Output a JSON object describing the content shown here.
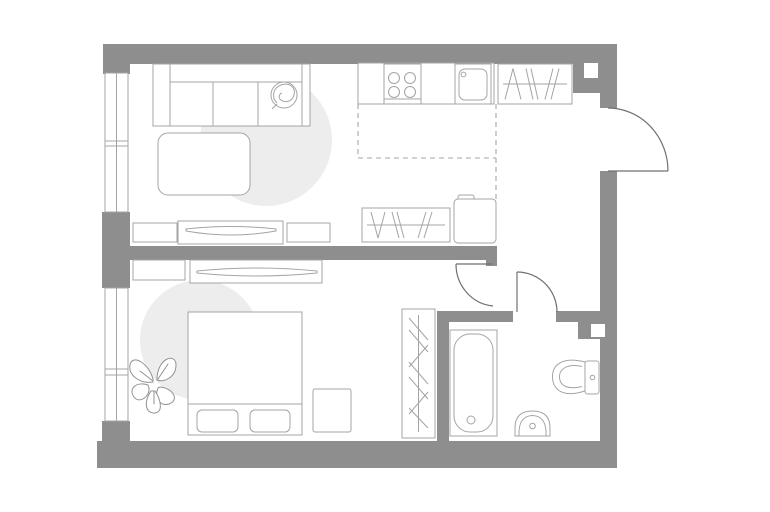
{
  "canvas": {
    "width": 770,
    "height": 512
  },
  "colors": {
    "background": "#ffffff",
    "wall": "#8e8e8e",
    "line": "#a4a4a4",
    "door_line": "#707070",
    "dash_line": "#a6a6a6",
    "rug": "#ededed",
    "plant_line": "#929292"
  },
  "drawing": {
    "type": "apartment-floor-plan",
    "fixtures": [
      "sofa-icon",
      "round-pillow-icon",
      "coffee-table-icon",
      "round-rug-icon",
      "tv-console-icon",
      "tv-icon",
      "media-cabinet-icon",
      "kitchen-counter-icon",
      "stove-icon",
      "kitchen-sink-icon",
      "wardrobe-hanging-clothes-icon",
      "refrigerator-icon",
      "kitchen-zone-dashed-boundary",
      "bed-icon",
      "bed-pillows-icon",
      "nightstand-icon",
      "dresser-icon",
      "plant-icon",
      "tall-wardrobe-icon",
      "bathtub-icon",
      "washbasin-icon",
      "toilet-icon",
      "window-icon",
      "entrance-door-swing-icon",
      "interior-door-swing-icon",
      "duct-shaft-icon"
    ],
    "doors": [
      "entrance-door-right-wall",
      "bedroom-door",
      "bathroom-door"
    ],
    "windows": [
      "living-room-window-left-wall",
      "bedroom-window-left-wall"
    ]
  }
}
